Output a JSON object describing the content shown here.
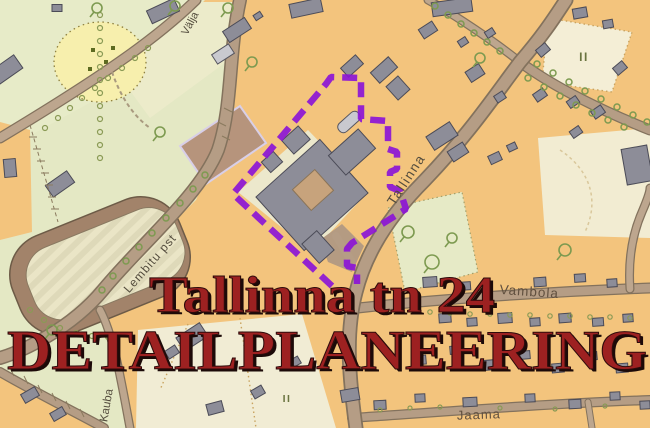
{
  "map": {
    "street_labels": {
      "valja": "Välja",
      "tallinna": "Tallinna",
      "lembitu_pst": "Lembitu pst",
      "vambola": "Vambola",
      "jaama": "Jaama",
      "kauba": "Kauba"
    },
    "block_markings": {
      "storeys_ne": "II",
      "storeys_s": "II"
    },
    "colors": {
      "boundary_purple": "#8c15d6",
      "block_orange": "#f3c47d",
      "park_green": "#e4e8c4",
      "road_fill": "#b59d85",
      "building_gray": "#8d8d98"
    }
  },
  "overlay": {
    "line1": "Tallinna tn 24",
    "line2": "DETAILPLANEERING",
    "color": "#9d2121",
    "shadow_color": "#1c0a08"
  }
}
